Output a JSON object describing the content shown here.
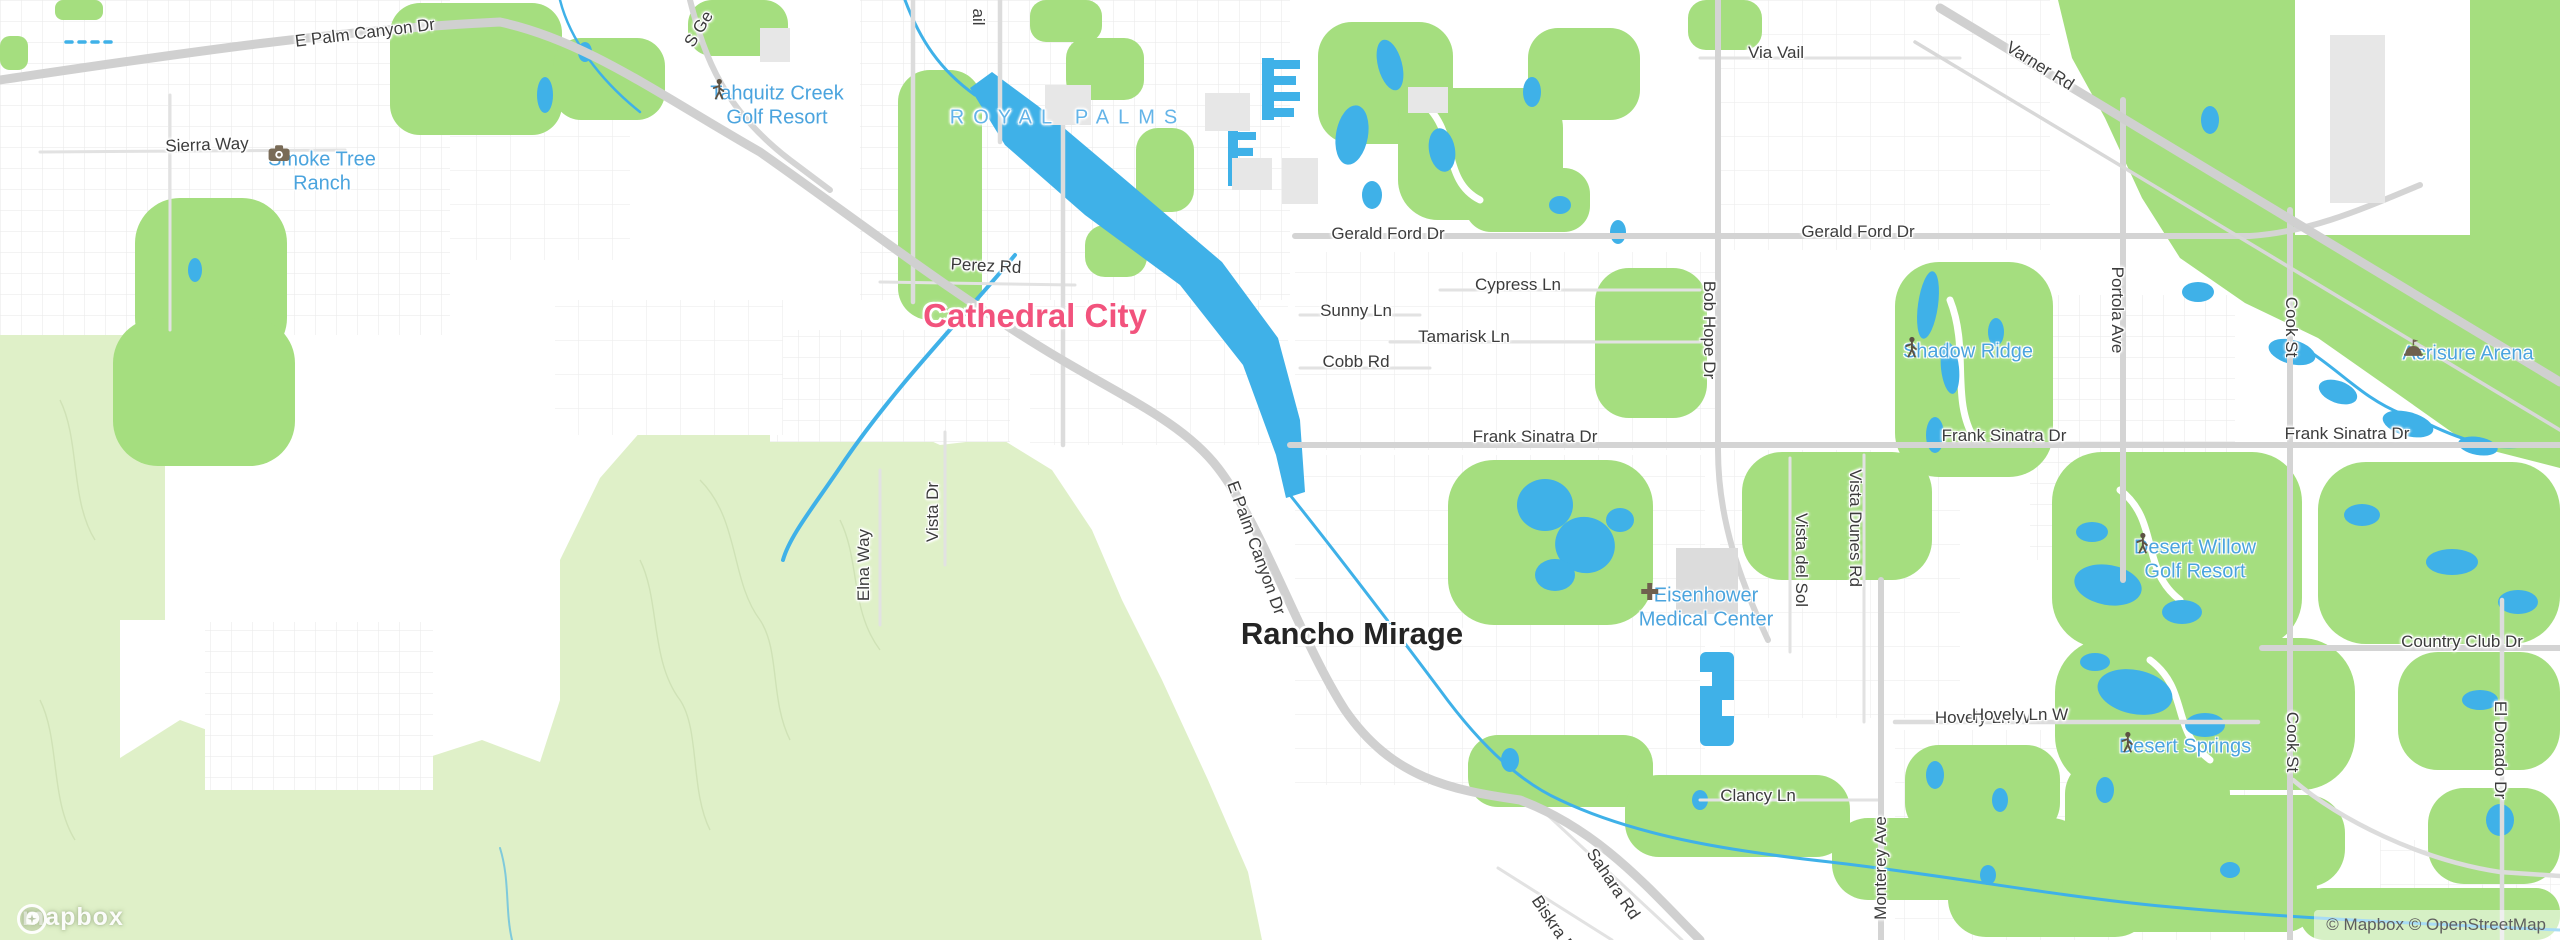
{
  "map": {
    "attribution": {
      "logo": "mapbox",
      "text": "© Mapbox © OpenStreetMap"
    },
    "colors": {
      "urban": "#ffffff",
      "terrain": "#dff0c8",
      "park": "#a5de7f",
      "water": "#3fb1e8",
      "road_major": "#d4d4d4",
      "road_minor": "#e5e5e5",
      "building": "#ebebeb",
      "city_label_pink": "#f2537d",
      "city_label_dark": "#242424",
      "poi_label": "#4ba4de",
      "neighborhood_label": "#64b4e8",
      "road_label": "#3c3c3c"
    },
    "city_labels": [
      {
        "t": "Cathedral City",
        "x": 1035,
        "y": 316,
        "c": "city-pink"
      },
      {
        "t": "Rancho Mirage",
        "x": 1352,
        "y": 634,
        "c": "city-dark"
      }
    ],
    "neighborhood_labels": [
      {
        "t": "ROYAL PALMS",
        "x": 1068,
        "y": 118
      }
    ],
    "poi_labels": [
      {
        "lines": [
          "Smoke Tree",
          "Ranch"
        ],
        "icon": "camera",
        "x": 322,
        "y": 170
      },
      {
        "lines": [
          "Tahquitz Creek",
          "Golf Resort"
        ],
        "icon": "golfer",
        "x": 777,
        "y": 104
      },
      {
        "lines": [
          "Shadow Ridge"
        ],
        "icon": "golfer",
        "x": 1968,
        "y": 350
      },
      {
        "lines": [
          "Acrisure Arena"
        ],
        "icon": "arena",
        "x": 2468,
        "y": 352
      },
      {
        "lines": [
          "Eisenhower",
          "Medical Center"
        ],
        "icon": "hospital",
        "x": 1706,
        "y": 606
      },
      {
        "lines": [
          "Desert Willow",
          "Golf Resort"
        ],
        "icon": "golfer",
        "x": 2195,
        "y": 558
      },
      {
        "lines": [
          "Desert Springs"
        ],
        "icon": "golfer",
        "x": 2185,
        "y": 745
      }
    ],
    "road_labels": [
      {
        "t": "E Palm Canyon Dr",
        "x": 365,
        "y": 33,
        "r": -7
      },
      {
        "t": "Sierra Way",
        "x": 207,
        "y": 145,
        "r": -2
      },
      {
        "t": "S Ge",
        "x": 699,
        "y": 29,
        "r": -58
      },
      {
        "t": "ail",
        "x": 978,
        "y": 17,
        "r": 90
      },
      {
        "t": "Perez Rd",
        "x": 986,
        "y": 266,
        "r": 3
      },
      {
        "t": "Via Vail",
        "x": 1776,
        "y": 53,
        "r": 0
      },
      {
        "t": "Varner Rd",
        "x": 2040,
        "y": 66,
        "r": 32
      },
      {
        "t": "Gerald Ford Dr",
        "x": 1388,
        "y": 234,
        "r": 0
      },
      {
        "t": "Gerald Ford Dr",
        "x": 1858,
        "y": 232,
        "r": 0
      },
      {
        "t": "Cypress Ln",
        "x": 1518,
        "y": 285,
        "r": 0
      },
      {
        "t": "Sunny Ln",
        "x": 1356,
        "y": 311,
        "r": 0
      },
      {
        "t": "Tamarisk Ln",
        "x": 1464,
        "y": 337,
        "r": 0
      },
      {
        "t": "Cobb Rd",
        "x": 1356,
        "y": 362,
        "r": 0
      },
      {
        "t": "Bob Hope Dr",
        "x": 1709,
        "y": 330,
        "r": 90
      },
      {
        "t": "Portola Ave",
        "x": 2117,
        "y": 310,
        "r": 90
      },
      {
        "t": "Cook St",
        "x": 2291,
        "y": 327,
        "r": 90
      },
      {
        "t": "Frank Sinatra Dr",
        "x": 1535,
        "y": 437,
        "r": 0
      },
      {
        "t": "Frank Sinatra Dr",
        "x": 2004,
        "y": 436,
        "r": 0
      },
      {
        "t": "Frank Sinatra Dr",
        "x": 2347,
        "y": 434,
        "r": 0
      },
      {
        "t": "Vista Dr",
        "x": 933,
        "y": 512,
        "r": -90
      },
      {
        "t": "Elna Way",
        "x": 864,
        "y": 565,
        "r": -90
      },
      {
        "t": "E Palm Canyon Dr",
        "x": 1256,
        "y": 548,
        "r": 70
      },
      {
        "t": "Vista del Sol",
        "x": 1801,
        "y": 560,
        "r": 90
      },
      {
        "t": "Vista Dunes Rd",
        "x": 1855,
        "y": 528,
        "r": 90
      },
      {
        "t": "Hovely Ln W",
        "x": 1983,
        "y": 718,
        "r": 0
      },
      {
        "t": "Country Club Dr",
        "x": 2462,
        "y": 642,
        "r": 0
      },
      {
        "t": "Clancy Ln",
        "x": 1758,
        "y": 796,
        "r": 0
      },
      {
        "t": "Monterey Ave",
        "x": 1881,
        "y": 868,
        "r": -90
      },
      {
        "t": "Sahara Rd",
        "x": 1613,
        "y": 884,
        "r": 56
      },
      {
        "t": "Biskra Rd",
        "x": 1556,
        "y": 928,
        "r": 56
      },
      {
        "t": "Cook St",
        "x": 2292,
        "y": 742,
        "r": 90
      },
      {
        "t": "El Dorado Dr",
        "x": 2500,
        "y": 750,
        "r": 90
      },
      {
        "t": "Hovely Ln W",
        "x": 2020,
        "y": 715,
        "r": 0
      }
    ]
  }
}
